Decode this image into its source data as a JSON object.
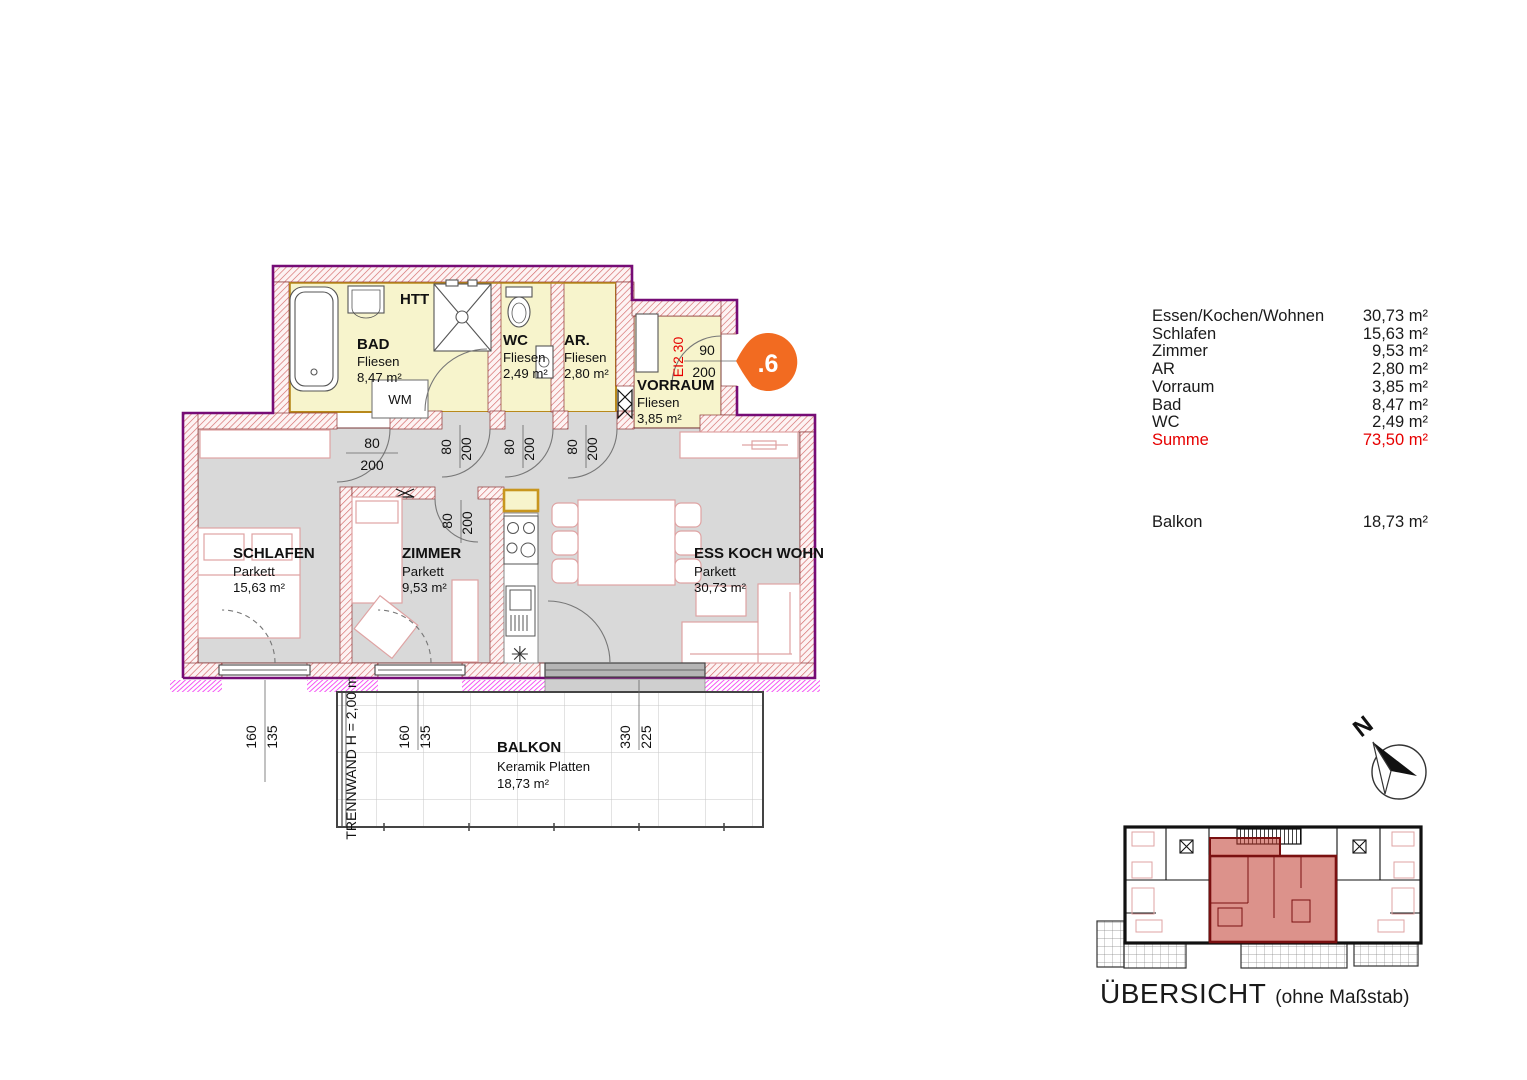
{
  "floorplan": {
    "rooms": {
      "bad": {
        "name": "BAD",
        "floor": "Fliesen",
        "area": "8,47 m²"
      },
      "wc": {
        "name": "WC",
        "floor": "Fliesen",
        "area": "2,49 m²"
      },
      "ar": {
        "name": "AR.",
        "floor": "Fliesen",
        "area": "2,80 m²"
      },
      "vorraum": {
        "name": "VORRAUM",
        "floor": "Fliesen",
        "area": "3,85 m²"
      },
      "schlafen": {
        "name": "SCHLAFEN",
        "floor": "Parkett",
        "area": "15,63 m²"
      },
      "zimmer": {
        "name": "ZIMMER",
        "floor": "Parkett",
        "area": "9,53 m²"
      },
      "wohnen": {
        "name": "ESS KOCH WOHN",
        "floor": "Parkett",
        "area": "30,73 m²"
      },
      "balkon": {
        "name": "BALKON",
        "floor": "Keramik Platten",
        "area": "18,73 m²"
      }
    },
    "annotations": {
      "htt": "HTT",
      "wm": "WM",
      "trennwand": "TRENNWAND H = 2,00 m",
      "fire_rating": "EI2 30",
      "unit_marker": ".6",
      "freezer_symbol": "✳"
    },
    "dimensions": {
      "door_w": "80",
      "door_h": "200",
      "entrance_w": "90",
      "entrance_h": "200",
      "window_w": "160",
      "window_h": "135",
      "terrace_door_w": "330",
      "terrace_door_h": "225"
    }
  },
  "area_table": {
    "rows": [
      {
        "label": "Essen/Kochen/Wohnen",
        "value": "30,73 m²"
      },
      {
        "label": "Schlafen",
        "value": "15,63 m²"
      },
      {
        "label": "Zimmer",
        "value": "9,53 m²"
      },
      {
        "label": "AR",
        "value": "2,80 m²"
      },
      {
        "label": "Vorraum",
        "value": "3,85 m²"
      },
      {
        "label": "Bad",
        "value": "8,47 m²"
      },
      {
        "label": "WC",
        "value": "2,49 m²"
      }
    ],
    "total": {
      "label": "Summe",
      "value": "73,50 m²"
    },
    "balcony": {
      "label": "Balkon",
      "value": "18,73 m²"
    }
  },
  "overview": {
    "title": "ÜBERSICHT",
    "subtitle": "(ohne Maßstab)",
    "north": "N"
  },
  "colors": {
    "wall_purple": "#760c76",
    "wall_hatch_red": "#d46a6a",
    "room_yellow": "#f7f4cc",
    "floor_gray": "#d9d9d9",
    "magenta_seal": "#f23cf2",
    "accent_orange": "#f26b21",
    "summe_red": "#e60000",
    "furniture_pink": "#dfa3a3",
    "overview_highlight": "#c0392b"
  }
}
